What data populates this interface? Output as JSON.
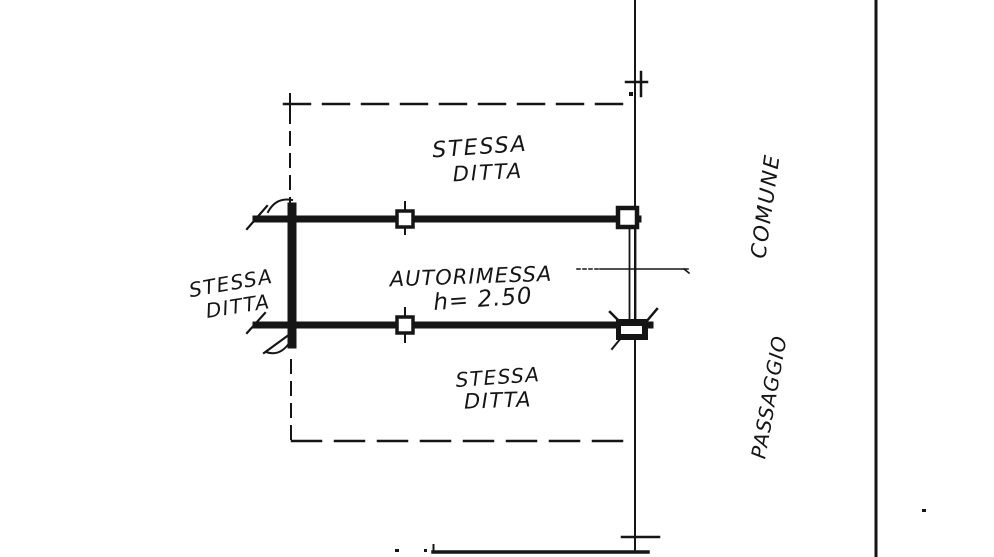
{
  "plan": {
    "room": {
      "name": "AUTORIMESSA",
      "height_note": "h= 2.50"
    },
    "adjacent_top": {
      "line1": "STESSA",
      "line2": "DITTA"
    },
    "adjacent_left": {
      "line1": "STESSA",
      "line2": "DITTA"
    },
    "adjacent_bottom": {
      "line1": "STESSA",
      "line2": "DITTA"
    },
    "passage": {
      "upper_word": "COMUNE",
      "lower_word": "PASSAGGIO"
    }
  },
  "colors": {
    "ink": "#151515",
    "paper": "#ffffff"
  }
}
